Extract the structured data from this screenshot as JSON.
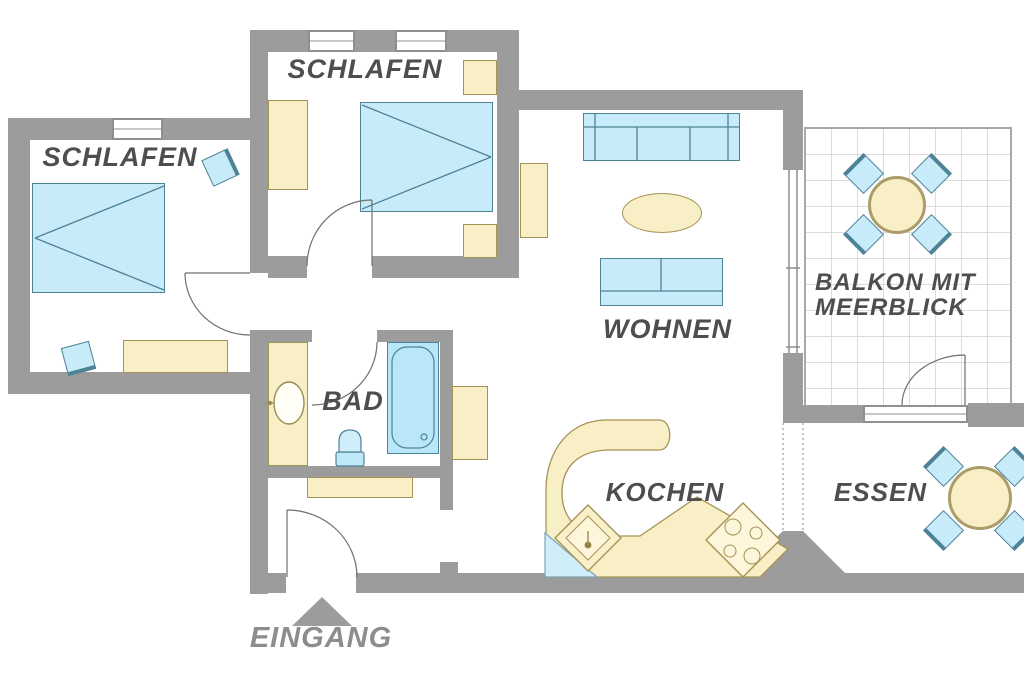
{
  "rooms": {
    "bedroom_left": {
      "label": "SCHLAFEN",
      "furniture": [
        "double-bed",
        "chair",
        "chair",
        "dresser"
      ]
    },
    "bedroom_top": {
      "label": "SCHLAFEN",
      "furniture": [
        "double-bed",
        "wardrobe",
        "nightstand",
        "nightstand"
      ]
    },
    "living": {
      "label": "WOHNEN",
      "furniture": [
        "sofa-large",
        "sofa-small",
        "coffee-table",
        "cabinet",
        "sideboard"
      ]
    },
    "bath": {
      "label": "BAD",
      "furniture": [
        "bathtub",
        "washbasin",
        "toilet",
        "vanity-counter"
      ]
    },
    "kitchen": {
      "label": "KOCHEN",
      "furniture": [
        "kitchen-counter",
        "kitchen-sink",
        "stove"
      ]
    },
    "dining": {
      "label": "ESSEN",
      "furniture": [
        "dining-table",
        "dining-chair",
        "dining-chair",
        "dining-chair",
        "dining-chair"
      ]
    },
    "balcony": {
      "line1": "BALKON MIT",
      "line2": "MEERBLICK",
      "furniture": [
        "balcony-table",
        "balcony-chair",
        "balcony-chair",
        "balcony-chair",
        "balcony-chair"
      ]
    },
    "hall": {
      "furniture": [
        "wardrobe"
      ]
    }
  },
  "entrance": {
    "label": "EINGANG"
  },
  "colors": {
    "wall": "#9c9c9c",
    "furniture_blue": "#c8ebf9",
    "furniture_blue_border": "#4e8296",
    "furniture_beige": "#f8efc7",
    "furniture_beige_border": "#a39356",
    "room_label": "#4e4e4e",
    "entrance_label": "#8d8d8d"
  }
}
